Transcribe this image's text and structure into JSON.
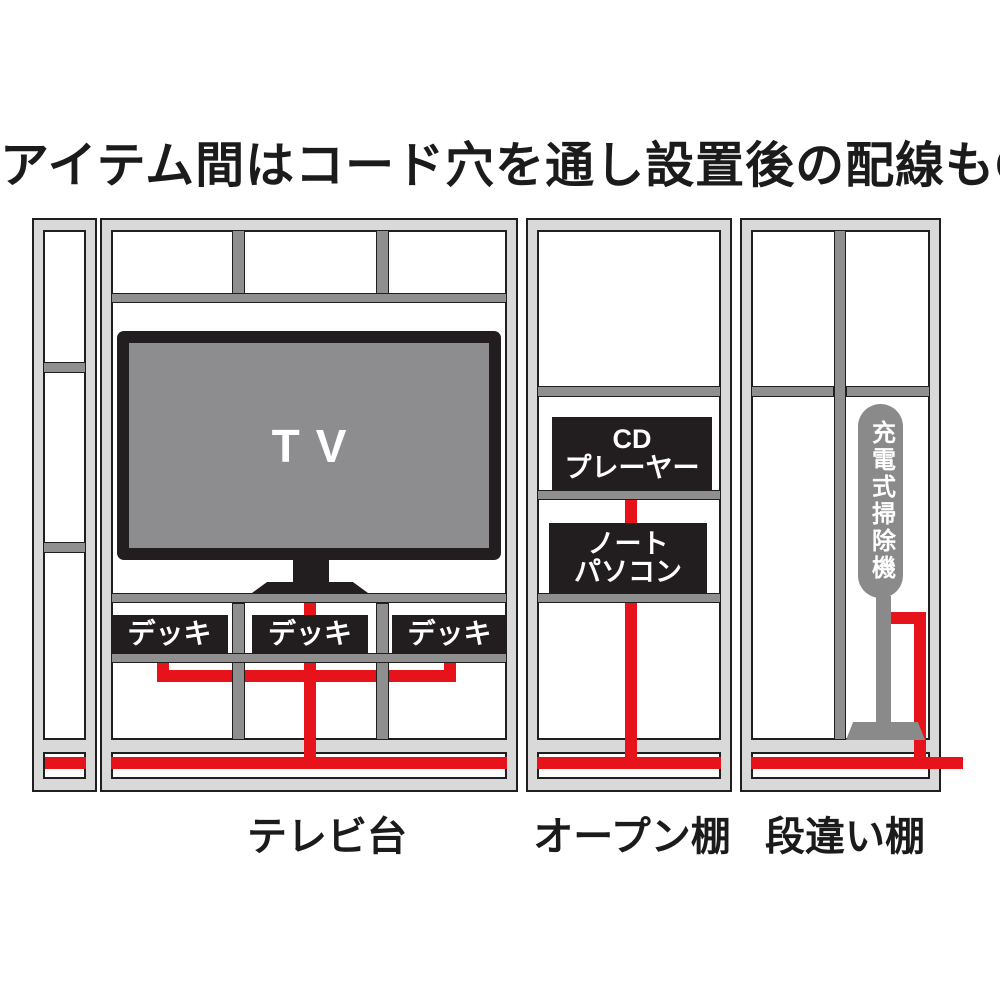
{
  "title": "アイテム間はコード穴を通し設置後の配線もOK",
  "units": {
    "tv_stand": {
      "label": "テレビ台",
      "tv_label": "TV",
      "deck_labels": [
        "デッキ",
        "デッキ",
        "デッキ"
      ]
    },
    "open_shelf": {
      "label": "オープン棚",
      "cd_player_line1": "CD",
      "cd_player_line2": "プレーヤー",
      "laptop_line1": "ノート",
      "laptop_line2": "パソコン"
    },
    "staggered_shelf": {
      "label": "段違い棚",
      "vacuum_label": "充電式掃除機"
    }
  },
  "colors": {
    "cable_red": "#e6131b",
    "frame_light_gray": "#d9d9d9",
    "shelf_gray": "#8f8f8f",
    "outline_dark": "#1f1f1f",
    "device_black": "#221e1f",
    "tv_screen_gray": "#8d8d8f",
    "vacuum_gray": "#8a8a8a"
  }
}
